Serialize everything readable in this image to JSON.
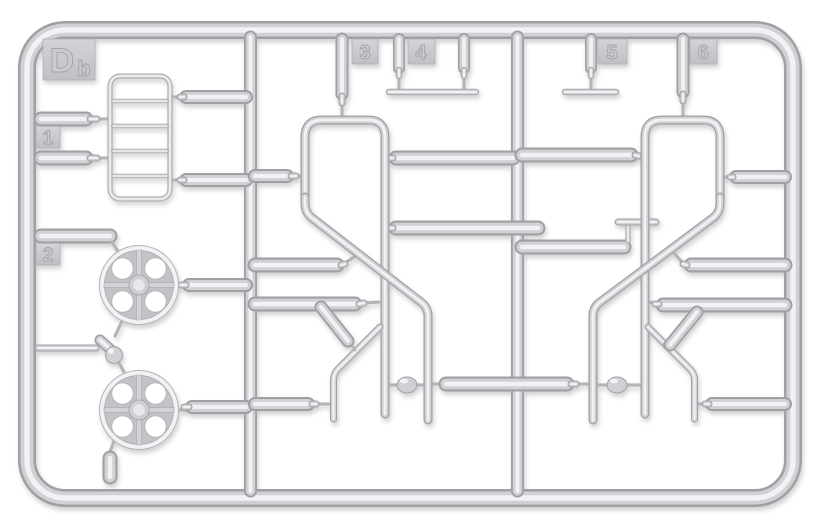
{
  "scene": {
    "description": "Injection-molded plastic model kit sprue (runner) photographed on white background",
    "background_color": "#ffffff"
  },
  "sprue": {
    "gate_label": {
      "main": "D",
      "sub": "b",
      "combined": "Db"
    },
    "part_tags": [
      "1",
      "2",
      "3",
      "4",
      "5",
      "6"
    ],
    "plastic": {
      "edge_color": "#9fa0a4",
      "body_color": "#d0d1d4",
      "highlight_color": "#f2f2f4",
      "wire_color": "#b4b5b9",
      "plate_light": "#d3d4d7",
      "plate_dark": "#bec0c3",
      "plate_stroke": "#aeafb2",
      "emboss_fill": "#cbccce",
      "emboss_stroke": "#a2a3a7",
      "wheel_face": "#c2c3c6",
      "wheel_rim": "#f1f2f4",
      "hub_inner": "#e8e9eb"
    }
  }
}
